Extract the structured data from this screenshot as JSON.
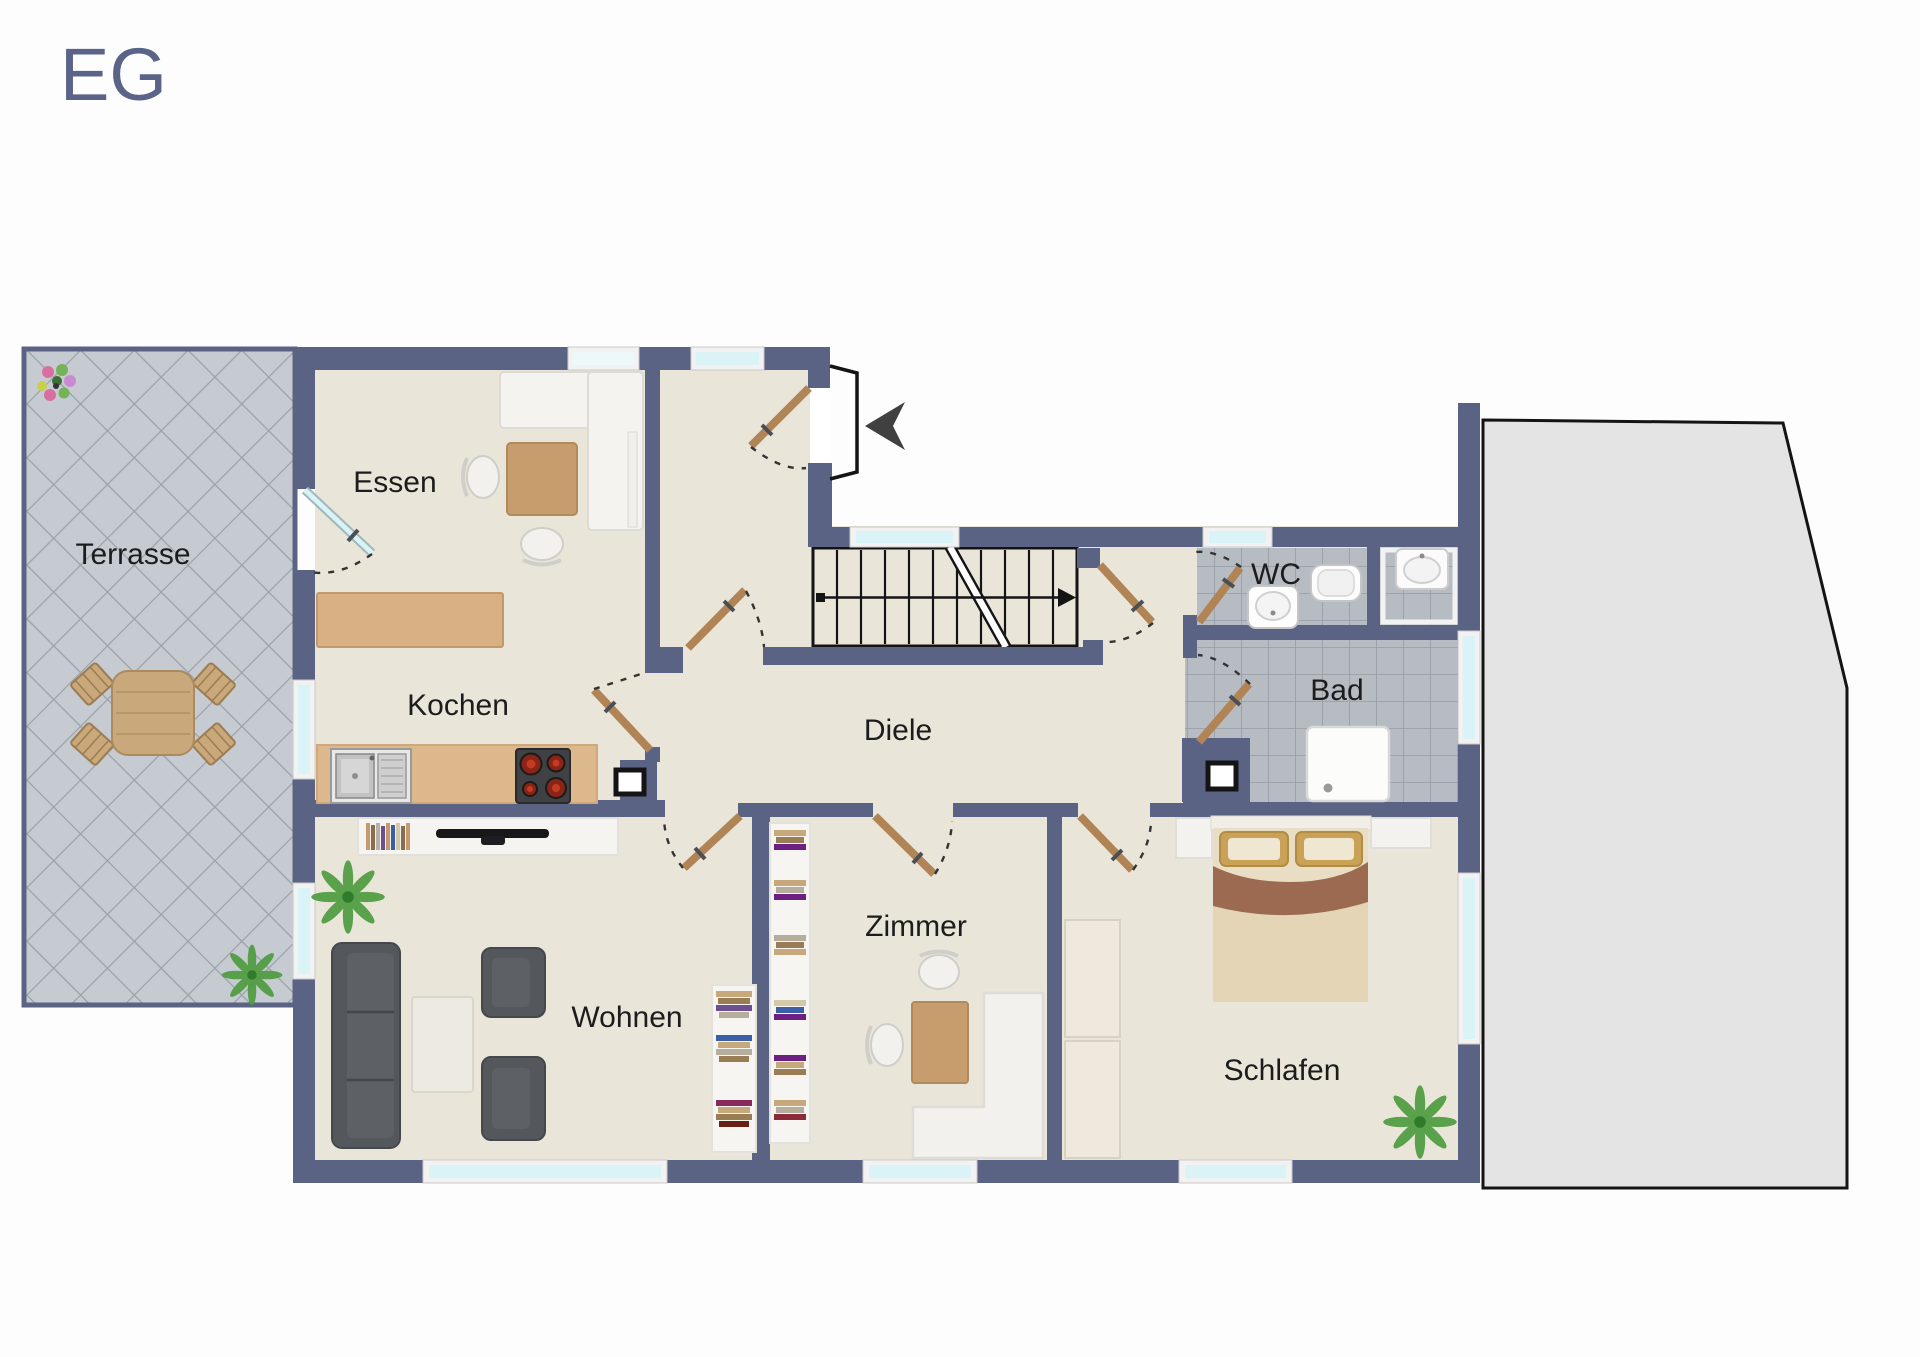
{
  "title": "EG",
  "rooms": {
    "terrasse": {
      "label": "Terrasse"
    },
    "essen": {
      "label": "Essen"
    },
    "kochen": {
      "label": "Kochen"
    },
    "diele": {
      "label": "Diele"
    },
    "wc": {
      "label": "WC"
    },
    "bad": {
      "label": "Bad"
    },
    "wohnen": {
      "label": "Wohnen"
    },
    "zimmer": {
      "label": "Zimmer"
    },
    "schlafen": {
      "label": "Schlafen"
    }
  },
  "icons": {
    "stairs-direction-arrow": "arrow-right",
    "entrance-direction-arrow": "arrow-left"
  },
  "colors": {
    "wall": "#5A6384",
    "floor": "#EAE5D9",
    "tile": "#B7BCC2",
    "terrace": "#C5CBD0",
    "window": "#D9F3F7",
    "garage": "#E4E4E4",
    "door": "#B08455",
    "wood": "#C79D6D",
    "dark": "#54575B",
    "label": "#1C1C1C",
    "title": "#5B6488"
  }
}
